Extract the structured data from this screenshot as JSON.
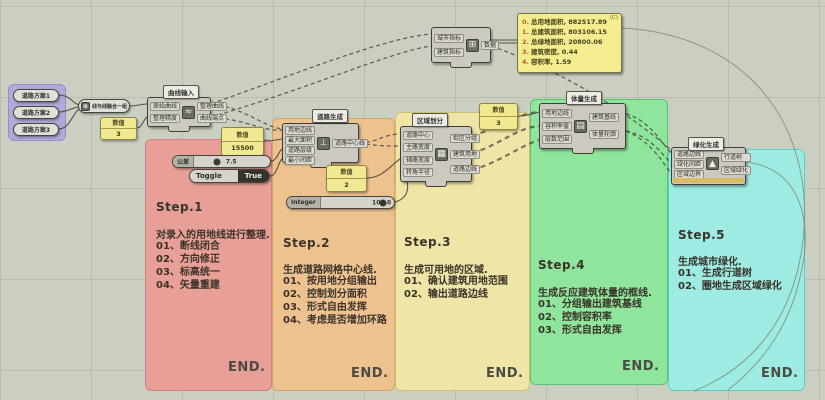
{
  "canvas": {
    "bg": "#cbcfc2",
    "grid": "rgba(90,95,85,0.16)"
  },
  "groups": [
    {
      "id": "step1",
      "color": "#e89f97",
      "step": "Step.1",
      "desc": "对录入的用地线进行整理.",
      "items": [
        "01、断线闭合",
        "02、方向修正",
        "03、标高统一",
        "04、矢量重建"
      ],
      "end": "END."
    },
    {
      "id": "step2",
      "color": "#eec28f",
      "step": "Step.2",
      "desc": "生成道路网格中心线.",
      "items": [
        "01、按用地分组输出",
        "02、控制划分面积",
        "03、形式自由发挥",
        "04、考虑是否增加环路"
      ],
      "end": "END."
    },
    {
      "id": "step3",
      "color": "#efe5a6",
      "step": "Step.3",
      "desc": "生成可用地的区域.",
      "items": [
        "01、确认建筑用地范围",
        "02、输出道路边线"
      ],
      "end": "END."
    },
    {
      "id": "step4",
      "color": "#8ee59b",
      "step": "Step.4",
      "desc": "生成反应建筑体量的框线.",
      "items": [
        "01、分组输出建筑基线",
        "02、控制容积率",
        "03、形式自由发挥"
      ],
      "end": "END."
    },
    {
      "id": "step5",
      "color": "#9debe2",
      "step": "Step.5",
      "desc": "生成城市绿化.",
      "items": [
        "01、生成行道树",
        "02、圈地生成区域绿化"
      ],
      "end": "END."
    }
  ],
  "sources": {
    "items": [
      "道路方案1",
      "道路方案2",
      "道路方案3"
    ]
  },
  "merge_node": {
    "label": "线与线融合一组"
  },
  "nodes": {
    "clean": {
      "tag": "曲线输入",
      "inputs": [
        "原始曲线",
        "整理精度"
      ],
      "outputs": [
        "整理曲线",
        "曲线端点"
      ]
    },
    "roads": {
      "tag": "道路生成",
      "inputs": [
        "用地边线",
        "最大面积",
        "道路层级",
        "最小间距"
      ],
      "outputs": [
        "道路中心线"
      ]
    },
    "regions": {
      "tag": "区域划分",
      "inputs": [
        "道路中心",
        "主路宽度",
        "辅路宽度",
        "转角半径"
      ],
      "outputs": [
        "街区分组",
        "建筑用地",
        "道路边线"
      ]
    },
    "massing": {
      "tag": "体量生成",
      "inputs": [
        "用地边线",
        "容积率值",
        "层数范围"
      ],
      "outputs": [
        "建筑基线",
        "体量轮廓"
      ]
    },
    "greening": {
      "tag": "绿化生成",
      "inputs": [
        "道路边线",
        "绿化间距",
        "区域边界"
      ],
      "outputs": [
        "行道树",
        "区域绿化"
      ]
    },
    "stats": {
      "inputs": [
        "城市指标",
        "建筑指标"
      ],
      "outputs": [
        "数据"
      ]
    }
  },
  "widgets": {
    "pick": {
      "label": "数值",
      "value": "3"
    },
    "spacing": {
      "label": "数值",
      "value": "15500"
    },
    "tol": {
      "label": "公差",
      "value": "7.5"
    },
    "toggle": {
      "label": "Toggle",
      "value": "True"
    },
    "count": {
      "label": "数值",
      "value": "2"
    },
    "integer": {
      "label": "Integer",
      "value": "100.0"
    },
    "far": {
      "label": "数值",
      "value": "3"
    }
  },
  "stats_panel": {
    "corner": "(C)",
    "lines": [
      {
        "n": "0.",
        "t": "总用地面积, 882517.89"
      },
      {
        "n": "1.",
        "t": "总建筑面积, 803106.15"
      },
      {
        "n": "2.",
        "t": "总绿地面积, 20800.06"
      },
      {
        "n": "3.",
        "t": "建筑密度, 0.44"
      },
      {
        "n": "4.",
        "t": "容积率, 1.59"
      }
    ]
  }
}
